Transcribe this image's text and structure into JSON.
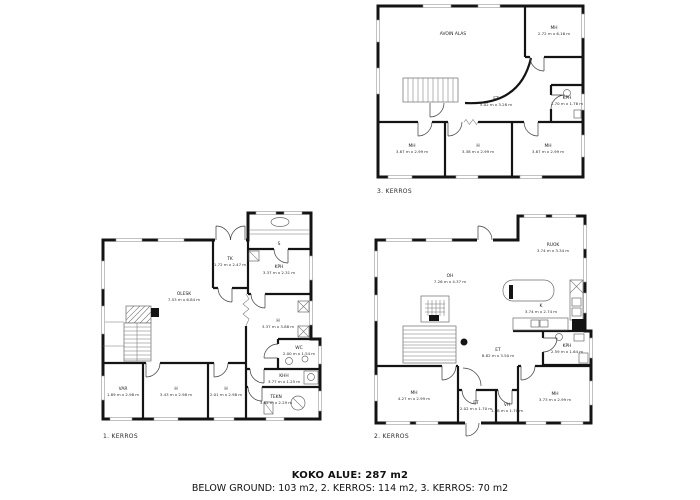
{
  "summary": {
    "total": "KOKO ALUE: 287 m2",
    "breakdown": "BELOW GROUND: 103 m2, 2. KERROS: 114 m2, 3. KERROS: 70 m2"
  },
  "colors": {
    "wall": "#141414",
    "background": "#ffffff",
    "text": "#1c1c1c"
  },
  "floors": [
    {
      "id": "floor-1",
      "label": "1. KERROS",
      "rooms": [
        {
          "name": "OLESK",
          "dims": "7.53 m x 6.84 m"
        },
        {
          "name": "TK",
          "dims": "1.72 m x 2.47 m"
        },
        {
          "name": "S",
          "dims": ""
        },
        {
          "name": "KPH",
          "dims": "3.37 m x 2.31 m"
        },
        {
          "name": "H",
          "dims": "3.37 m x 3.88 m"
        },
        {
          "name": "WC",
          "dims": "2.00 m x 1.54 m"
        },
        {
          "name": "KHH",
          "dims": "3.77 m x 1.25 m"
        },
        {
          "name": "TEKN",
          "dims": "3.82 m x 2.29 m"
        },
        {
          "name": "VAR",
          "dims": "1.89 m x 2.98 m"
        },
        {
          "name": "H",
          "dims": "3.43 m x 2.98 m"
        },
        {
          "name": "H",
          "dims": "2.01 m x 2.98 m"
        }
      ]
    },
    {
      "id": "floor-2",
      "label": "2. KERROS",
      "rooms": [
        {
          "name": "OH",
          "dims": "7.26 m x 4.37 m"
        },
        {
          "name": "RUOK",
          "dims": "3.74 m x 3.34 m"
        },
        {
          "name": "K",
          "dims": "3.74 m x 2.74 m"
        },
        {
          "name": "ET",
          "dims": "8.82 m x 3.50 m"
        },
        {
          "name": "KPH",
          "dims": "2.59 m x 1.64 m"
        },
        {
          "name": "MH",
          "dims": "4.27 m x 2.99 m"
        },
        {
          "name": "ET",
          "dims": "2.02 m x 1.70 m"
        },
        {
          "name": "VH",
          "dims": "1.18 m x 1.70 m"
        },
        {
          "name": "MH",
          "dims": "3.73 m x 2.99 m"
        }
      ]
    },
    {
      "id": "floor-3",
      "label": "3. KERROS",
      "rooms": [
        {
          "name": "AVOIN ALAS",
          "dims": ""
        },
        {
          "name": "MH",
          "dims": "2.72 m x 6.16 m"
        },
        {
          "name": "ET",
          "dims": "5.02 m x 3.28 m"
        },
        {
          "name": "KPH",
          "dims": "1.70 m x 1.76 m"
        },
        {
          "name": "MH",
          "dims": "3.87 m x 2.99 m"
        },
        {
          "name": "H",
          "dims": "3.38 m x 2.99 m"
        },
        {
          "name": "MH",
          "dims": "3.87 m x 2.99 m"
        }
      ]
    }
  ]
}
